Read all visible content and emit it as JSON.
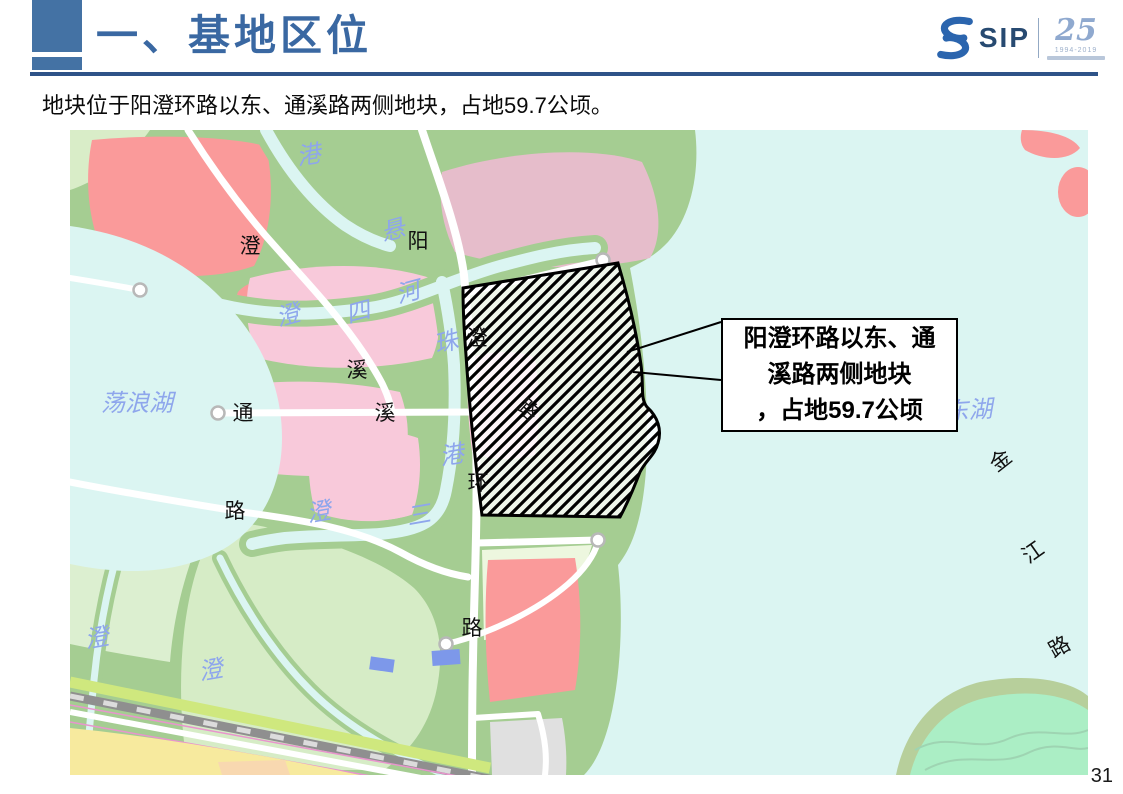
{
  "slide": {
    "title": "一、基地区位",
    "subtitle": "地块位于阳澄环路以东、通溪路两侧地块，占地59.7公顷。",
    "page_number": "31"
  },
  "logo": {
    "brand": "SIP",
    "anniversary_number": "25",
    "anniversary_years": "1994-2019"
  },
  "callout": {
    "line1": "阳澄环路以东、通",
    "line2": "溪路两侧地块",
    "line3": "，占地59.7公顷"
  },
  "map": {
    "colors": {
      "water": "#dbf5f2",
      "land_green": "#a5cd92",
      "pink_parcel": "#f8c9da",
      "salmon_parcel": "#fa9a9a",
      "dusty_pink_parcel": "#e6bdcb",
      "pale_green_parcel": "#d9edc8",
      "mint_island": "#abeec5",
      "yellow_parcel": "#f7ea9e",
      "gray_parcel": "#e0e0e0",
      "water_label_blue": "#8ea6ec",
      "accent_blue": "#3a68a2"
    },
    "road_labels": [
      {
        "text": "澄",
        "x": 180,
        "y": 123
      },
      {
        "text": "阳",
        "x": 348,
        "y": 118
      },
      {
        "text": "溪",
        "x": 287,
        "y": 247
      },
      {
        "text": "通",
        "x": 173,
        "y": 290
      },
      {
        "text": "溪",
        "x": 315,
        "y": 290
      },
      {
        "text": "路",
        "x": 165,
        "y": 388
      },
      {
        "text": "路",
        "x": 402,
        "y": 505
      },
      {
        "text": "金",
        "x": 935,
        "y": 336,
        "rot": -38
      },
      {
        "text": "江",
        "x": 967,
        "y": 428,
        "rot": -35
      },
      {
        "text": "路",
        "x": 993,
        "y": 523,
        "rot": -30
      },
      {
        "text": "澄",
        "x": 407,
        "y": 215,
        "layer": "over"
      },
      {
        "text": "路",
        "x": 453,
        "y": 285,
        "rot": 42,
        "layer": "over"
      },
      {
        "text": "环",
        "x": 408,
        "y": 360,
        "layer": "over"
      }
    ],
    "water_labels": [
      {
        "text": "港",
        "x": 240,
        "y": 33,
        "rot": -10
      },
      {
        "text": "悬",
        "x": 325,
        "y": 108,
        "rot": -15
      },
      {
        "text": "四",
        "x": 290,
        "y": 190,
        "rot": -15
      },
      {
        "text": "河",
        "x": 340,
        "y": 170,
        "rot": -15
      },
      {
        "text": "澄",
        "x": 220,
        "y": 193,
        "rot": -15
      },
      {
        "text": "珠",
        "x": 378,
        "y": 220,
        "rot": -15
      },
      {
        "text": "荡浪湖",
        "x": 67,
        "y": 281,
        "size": 26
      },
      {
        "text": "港",
        "x": 383,
        "y": 333,
        "rot": -10
      },
      {
        "text": "三",
        "x": 350,
        "y": 393,
        "rot": -10
      },
      {
        "text": "澄",
        "x": 250,
        "y": 390,
        "rot": -10
      },
      {
        "text": "澄",
        "x": 28,
        "y": 516,
        "rot": -10
      },
      {
        "text": "澄",
        "x": 142,
        "y": 548,
        "rot": -10
      },
      {
        "text": "阳澄东湖",
        "x": 875,
        "y": 290,
        "size": 32,
        "rot": -4
      }
    ]
  }
}
